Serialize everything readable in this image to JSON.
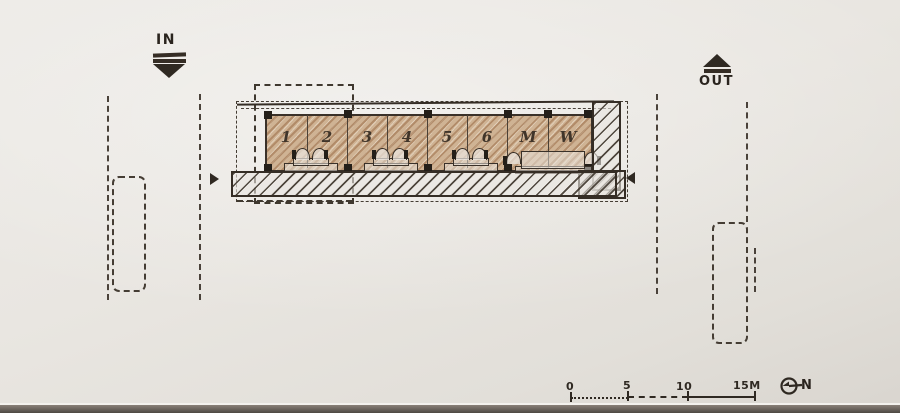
{
  "photo": {
    "paper_color": "#e9e6e1",
    "ink_color": "#352d25",
    "pencil_shading_color": "#b08a63"
  },
  "markers": {
    "in_label": "IN",
    "out_label": "OUT"
  },
  "plan": {
    "room_labels": [
      "1",
      "2",
      "3",
      "4",
      "5",
      "6",
      "M",
      "W"
    ]
  },
  "scale_bar": {
    "tick_labels": [
      "0",
      "5",
      "10",
      "15M"
    ]
  },
  "north": {
    "label": "N"
  }
}
